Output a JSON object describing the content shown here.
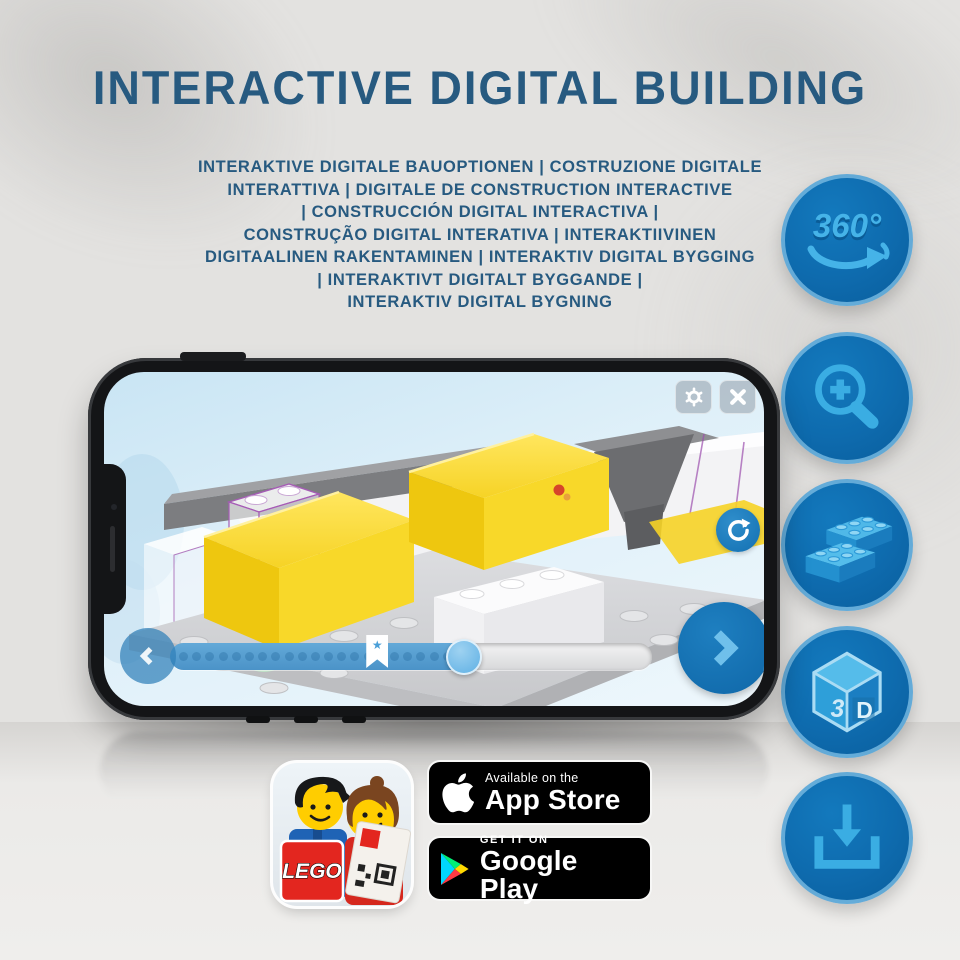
{
  "header": {
    "title": "INTERACTIVE DIGITAL BUILDING"
  },
  "subtitle": {
    "lines": [
      "INTERAKTIVE DIGITALE BAUOPTIONEN | COSTRUZIONE DIGITALE",
      "INTERATTIVA | DIGITALE DE CONSTRUCTION INTERACTIVE",
      "| CONSTRUCCIÓN DIGITAL INTERACTIVA |",
      "CONSTRUÇÃO DIGITAL INTERATIVA | INTERAKTIIVINEN",
      "DIGITAALINEN RAKENTAMINEN | INTERAKTIV DIGITAL BYGGING",
      "| INTERAKTIVT DIGITALT BYGGANDE |",
      "INTERAKTIV DIGITAL BYGNING"
    ]
  },
  "feature_buttons": [
    {
      "id": "rotate-360",
      "text": "360°"
    },
    {
      "id": "zoom-in"
    },
    {
      "id": "brick"
    },
    {
      "id": "view-3d",
      "face_left": "3",
      "face_right": "D"
    },
    {
      "id": "download"
    }
  ],
  "phone_ui": {
    "progress": {
      "fill_percent": 61,
      "dot_count": 22,
      "flag_percent": 43
    }
  },
  "app_icon": {
    "logo_text": "LEGO"
  },
  "store_badges": {
    "app_store": {
      "tagline": "Available on the",
      "name": "App Store"
    },
    "google_play": {
      "tagline": "GET IT ON",
      "name": "Google Play"
    }
  },
  "colors": {
    "title_blue": "#275a80",
    "button_blue": "#0e6bae",
    "glyph_blue": "#3aade3",
    "lego_red": "#d01012",
    "brick_yellow": "#f6d326"
  }
}
